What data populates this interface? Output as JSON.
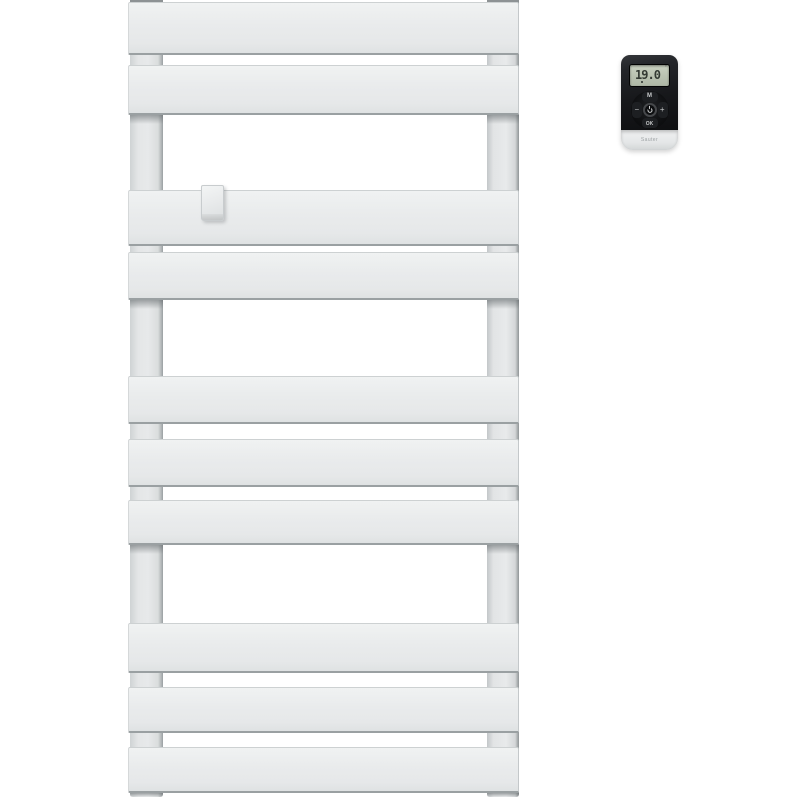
{
  "scene": {
    "background": "#ffffff",
    "subject": "White flat-panel electric heated towel rail radiator with wireless remote thermostat"
  },
  "radiator": {
    "panel_count": 10,
    "panel_color": "#e9ebec",
    "rail_color": "#e2e4e5",
    "edge_color": "#9aa0a2",
    "has_towel_hook": true
  },
  "remote": {
    "display_value": "19.0",
    "degree_symbol": "°",
    "buttons": {
      "mode": "M",
      "minus": "−",
      "plus": "+",
      "ok": "OK",
      "power": "power-icon"
    },
    "brand": "Sauter",
    "lcd_color": "#b9c2b0",
    "body_color": "#1b1c1f",
    "base_color": "#e8eaeb"
  }
}
